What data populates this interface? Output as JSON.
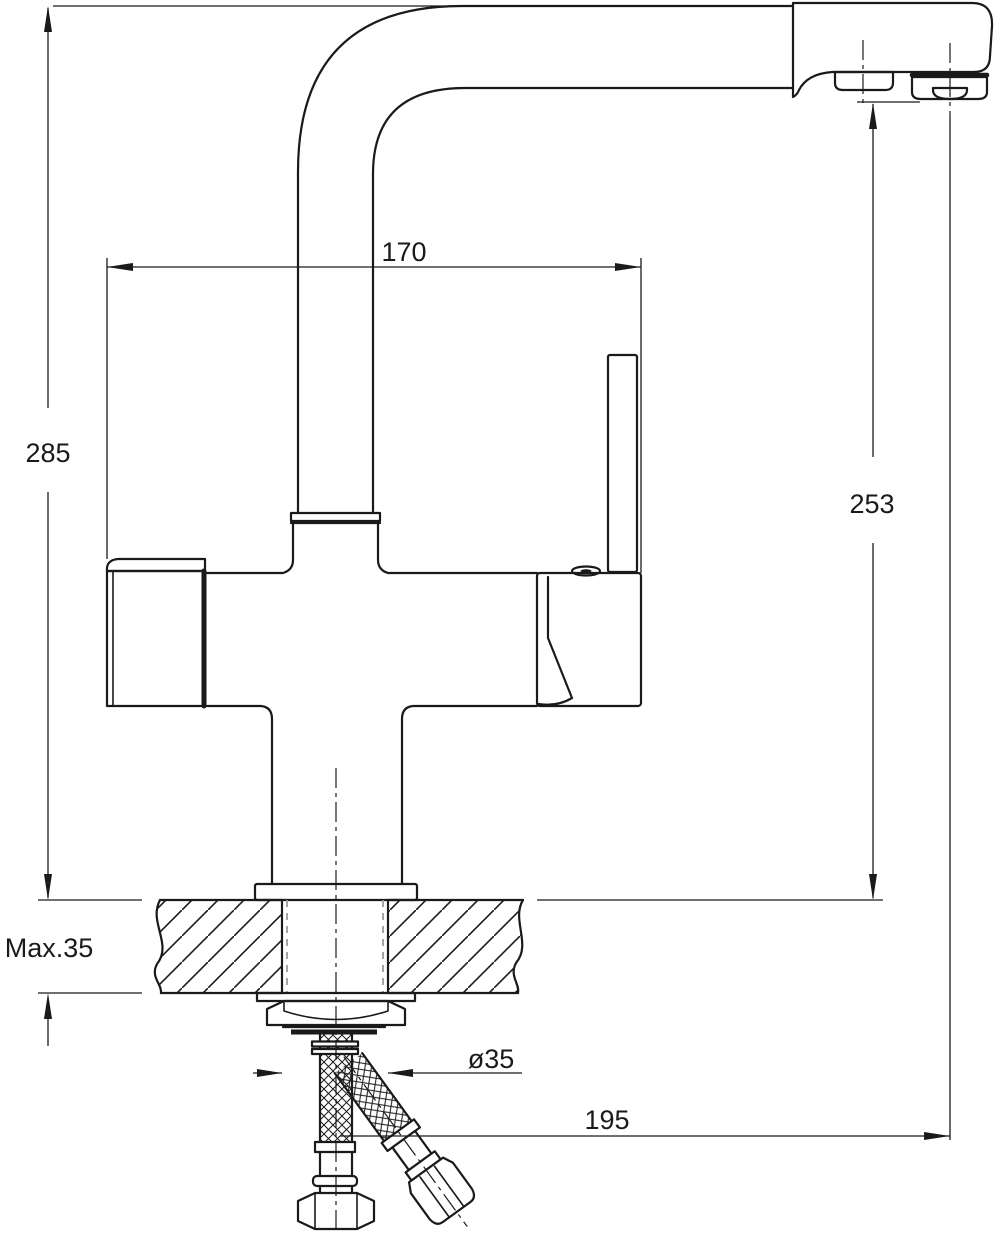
{
  "drawing": {
    "type": "technical-dimension-drawing",
    "subject": "kitchen-faucet-side-view",
    "background_color": "#ffffff",
    "line_color": "#1a1a1a",
    "hidden_line_color": "#9a9a9a",
    "dimensions": {
      "overall_height": "285",
      "spout_reach": "170",
      "spout_outlet_height": "253",
      "max_mounting_thickness": "Max.35",
      "mounting_hole_diameter": "ø35",
      "outlet_offset": "195"
    }
  }
}
